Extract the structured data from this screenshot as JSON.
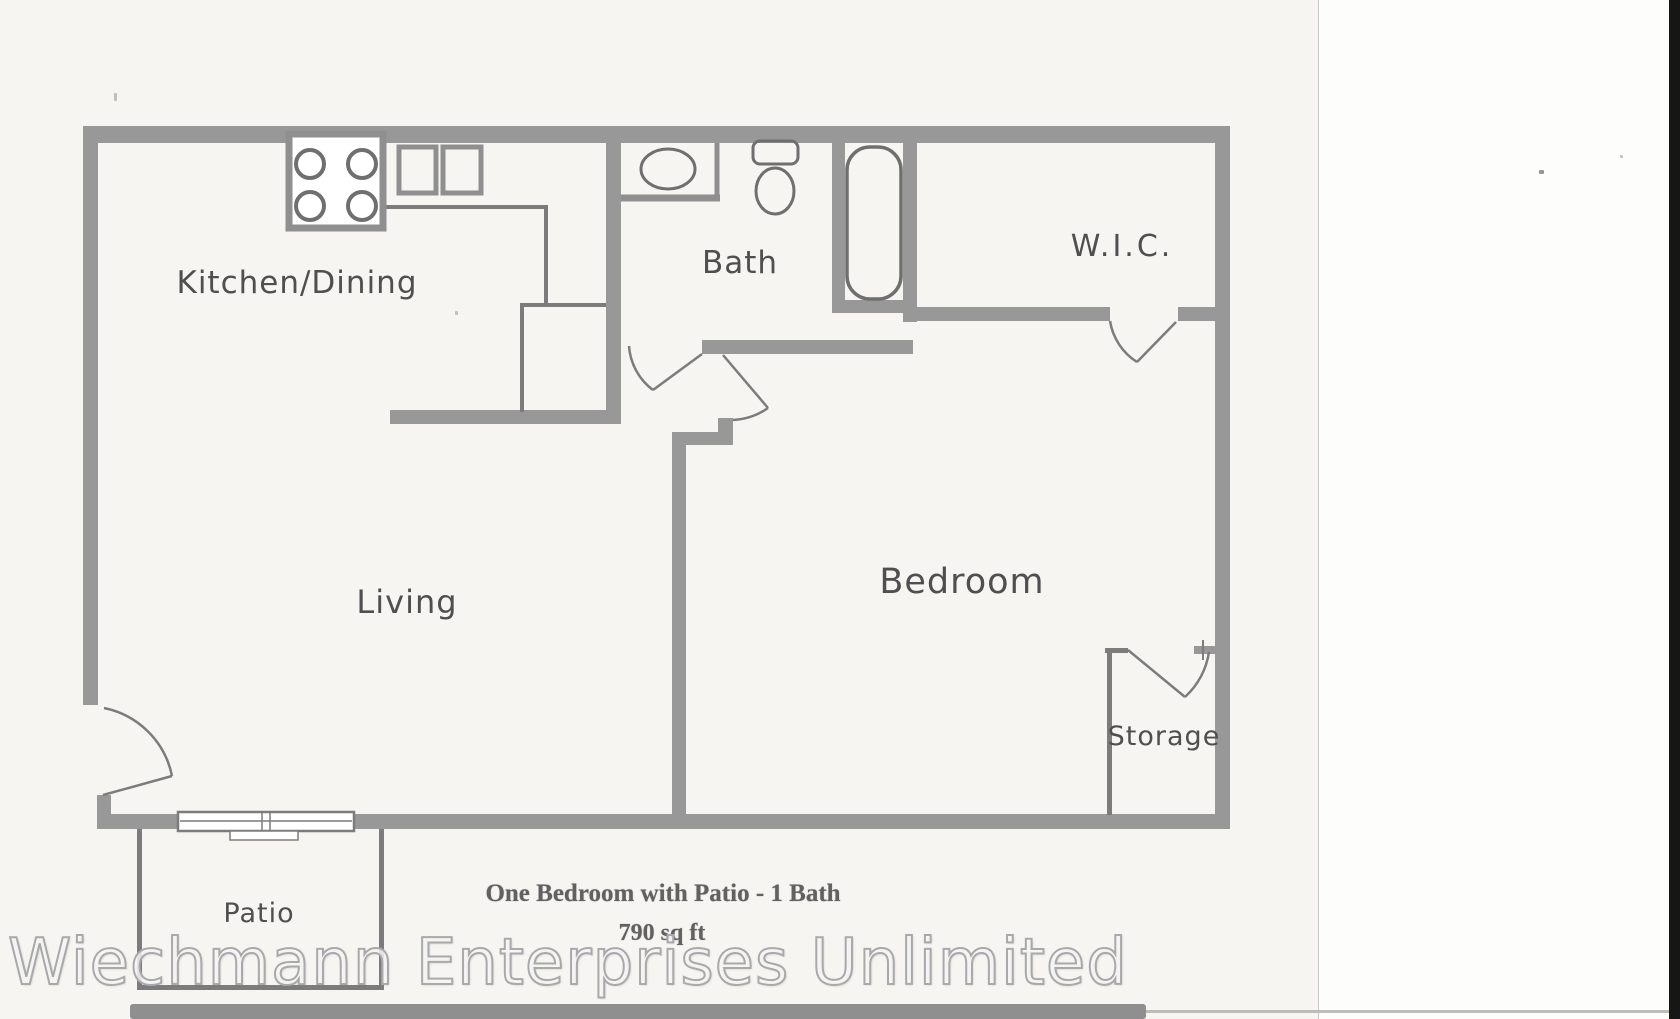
{
  "page": {
    "background_color": "#f7f5f1",
    "right_panel_color": "#fdfdfc",
    "edge_strip_color": "#161616"
  },
  "plan": {
    "wall_color": "#989898",
    "thin_line_color": "#7c7c7c",
    "fixture_line_color": "#6f6f6f",
    "rooms": {
      "kitchen": {
        "label": "Kitchen/Dining"
      },
      "bath": {
        "label": "Bath"
      },
      "wic": {
        "label": "W.I.C."
      },
      "living": {
        "label": "Living"
      },
      "bedroom": {
        "label": "Bedroom"
      },
      "storage": {
        "label": "Storage"
      },
      "patio": {
        "label": "Patio"
      }
    },
    "fixtures": [
      "stove-icon",
      "kitchen-sink-icon",
      "vanity-sink-icon",
      "toilet-icon",
      "bathtub-icon",
      "sliding-door-icon",
      "door-swing-icon"
    ]
  },
  "caption": {
    "title": "One Bedroom with Patio - 1 Bath",
    "area": "790 sq ft"
  },
  "watermark": {
    "text": "Wiechmann Enterprises Unlimited",
    "fill_color": "#ffffff",
    "outline_color": "#a9a9a9"
  }
}
